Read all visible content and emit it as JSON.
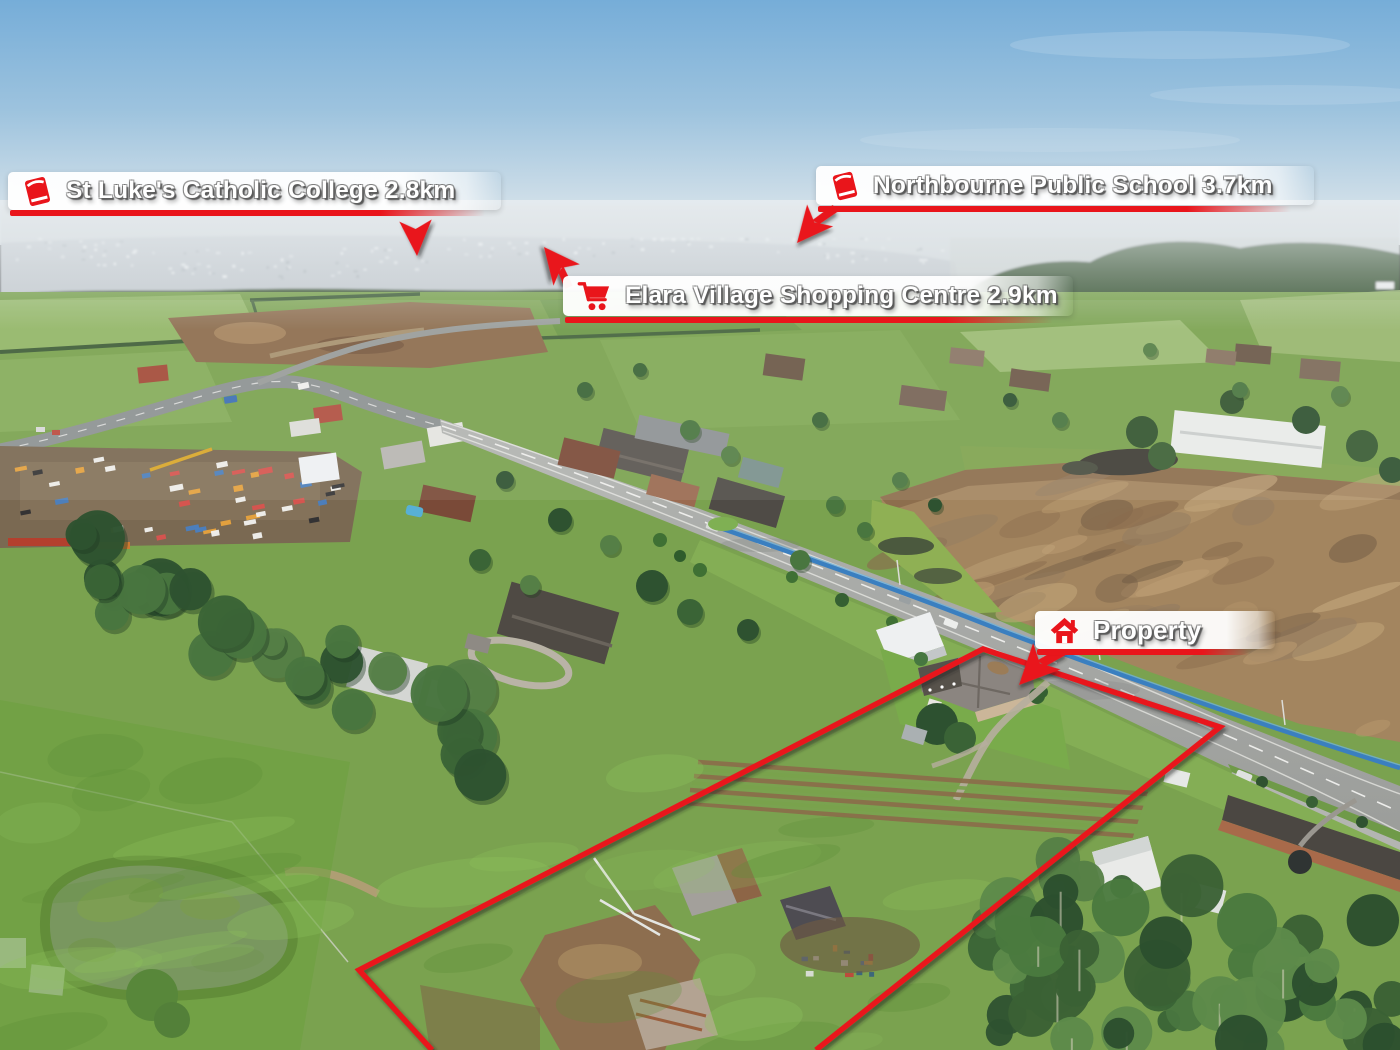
{
  "scene": {
    "description": "Aerial drone photograph of a semi-rural acreage property beside a main road, with marketing distance callouts and a red property boundary outline"
  },
  "colors": {
    "accent_red": "#e9151b",
    "label_bg": "#ffffff",
    "label_text": "#ffffff",
    "fence_blue": "#3a7fc0"
  },
  "callouts": [
    {
      "id": "st-lukes-college",
      "icon": "book-icon",
      "label": "St Luke's Catholic College 2.8km"
    },
    {
      "id": "northbourne-school",
      "icon": "book-icon",
      "label": "Northbourne Public School 3.7km"
    },
    {
      "id": "elara-shopping",
      "icon": "shopping-cart-icon",
      "label": "Elara Village Shopping Centre 2.9km"
    },
    {
      "id": "property",
      "icon": "house-icon",
      "label": "Property"
    }
  ],
  "annotations": {
    "property_boundary_shown": true,
    "boundary_color": "#e9151b",
    "arrow_count": 4
  }
}
